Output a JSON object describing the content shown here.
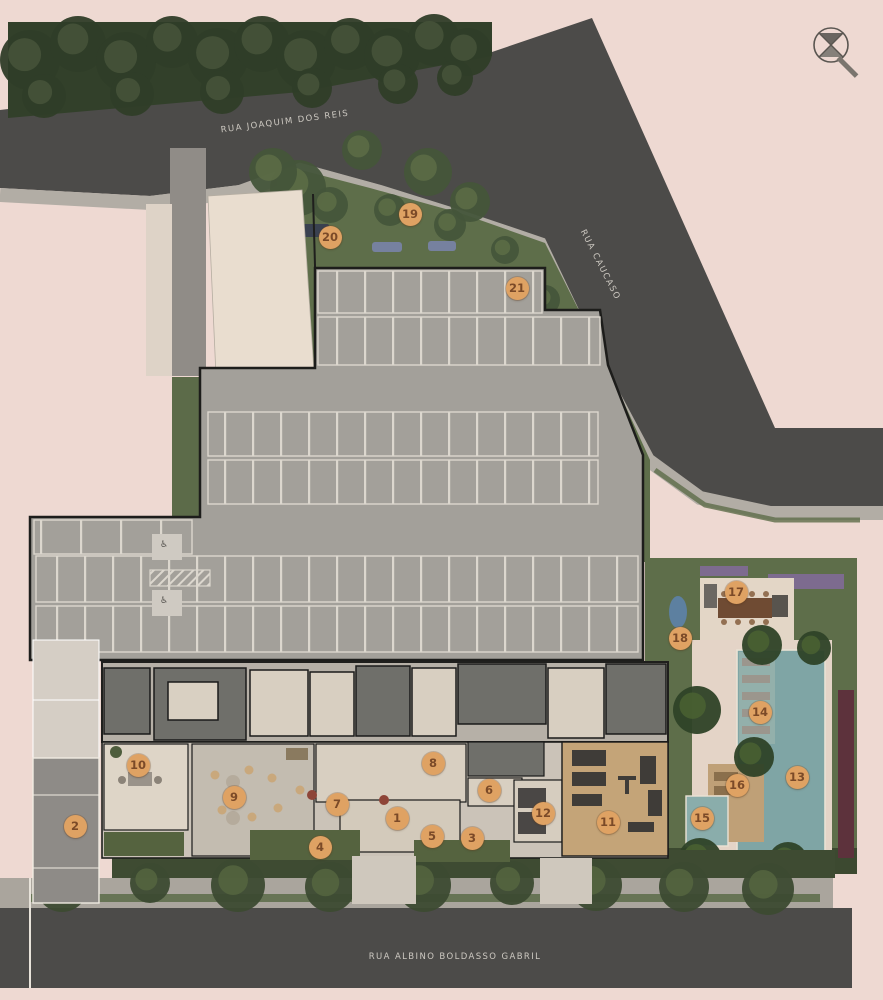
{
  "plan": {
    "title": "residential site / implantation plan",
    "streets": {
      "top": "RUA JOAQUIM DOS REIS",
      "right": "RUA CAUCASO",
      "bottom": "RUA ALBINO BOLDASSO GABRIL"
    },
    "compass": "north-compass",
    "markers": [
      {
        "n": "1",
        "x": 397,
        "y": 818
      },
      {
        "n": "2",
        "x": 75,
        "y": 826
      },
      {
        "n": "3",
        "x": 472,
        "y": 838
      },
      {
        "n": "4",
        "x": 320,
        "y": 847
      },
      {
        "n": "5",
        "x": 432,
        "y": 836
      },
      {
        "n": "6",
        "x": 489,
        "y": 790
      },
      {
        "n": "7",
        "x": 337,
        "y": 804
      },
      {
        "n": "8",
        "x": 433,
        "y": 763
      },
      {
        "n": "9",
        "x": 234,
        "y": 797
      },
      {
        "n": "10",
        "x": 138,
        "y": 765
      },
      {
        "n": "11",
        "x": 608,
        "y": 822
      },
      {
        "n": "12",
        "x": 543,
        "y": 813
      },
      {
        "n": "13",
        "x": 797,
        "y": 777
      },
      {
        "n": "14",
        "x": 760,
        "y": 712
      },
      {
        "n": "15",
        "x": 702,
        "y": 818
      },
      {
        "n": "16",
        "x": 737,
        "y": 785
      },
      {
        "n": "17",
        "x": 736,
        "y": 592
      },
      {
        "n": "18",
        "x": 680,
        "y": 638
      },
      {
        "n": "19",
        "x": 410,
        "y": 214
      },
      {
        "n": "20",
        "x": 330,
        "y": 237
      },
      {
        "n": "21",
        "x": 517,
        "y": 288
      }
    ]
  },
  "colors": {
    "background": "#eed9d2",
    "street": "#4c4b49",
    "sidewalk": "#b2ada5",
    "forest": "#32402a",
    "lawn": "#5e6e4a",
    "parking": "#a3a09a",
    "stall_line": "#dcd7ce",
    "building_dark": "#6f6f6a",
    "building_cream": "#d8cfc1",
    "wood_deck": "#c4a478",
    "pool_water": "#7fa5a5",
    "kids_pool": "#8aadab",
    "purple_bed": "#7d6b8f",
    "maroon_bed": "#5d323c",
    "marker_bg": "#dfa263",
    "marker_text": "#7b4a28",
    "label_text": "#e8e3da"
  },
  "foliage": {
    "forest": {
      "fill": "#2f3d28",
      "core": "#46543a",
      "dots": [
        [
          30,
          60,
          30
        ],
        [
          78,
          44,
          28
        ],
        [
          126,
          62,
          30
        ],
        [
          172,
          42,
          26
        ],
        [
          218,
          58,
          30
        ],
        [
          262,
          44,
          28
        ],
        [
          306,
          60,
          30
        ],
        [
          350,
          44,
          26
        ],
        [
          392,
          56,
          28
        ],
        [
          434,
          40,
          26
        ],
        [
          468,
          52,
          24
        ],
        [
          44,
          96,
          22
        ],
        [
          132,
          94,
          22
        ],
        [
          222,
          92,
          22
        ],
        [
          312,
          88,
          20
        ],
        [
          398,
          84,
          20
        ],
        [
          455,
          78,
          18
        ]
      ]
    },
    "garden": {
      "fill": "#44553a",
      "core": "#5d6d46",
      "dots": [
        [
          298,
          188,
          28
        ],
        [
          273,
          172,
          24
        ],
        [
          362,
          150,
          20
        ],
        [
          428,
          172,
          24
        ],
        [
          470,
          202,
          20
        ],
        [
          330,
          205,
          18
        ],
        [
          390,
          210,
          16
        ],
        [
          450,
          225,
          16
        ],
        [
          505,
          250,
          14
        ],
        [
          545,
          300,
          15
        ],
        [
          572,
          342,
          14
        ]
      ]
    },
    "caucaso": {
      "fill": "#44553a",
      "core": "#5d6d46",
      "dots": [
        [
          497,
          128,
          20
        ],
        [
          528,
          200,
          22
        ],
        [
          560,
          274,
          22
        ],
        [
          594,
          348,
          22
        ],
        [
          632,
          418,
          22
        ],
        [
          694,
          470,
          20
        ],
        [
          790,
          488,
          22
        ],
        [
          850,
          492,
          16
        ]
      ]
    },
    "bottom": {
      "fill": "#3c4a31",
      "core": "#55653f",
      "dots": [
        [
          62,
          886,
          26
        ],
        [
          150,
          883,
          20
        ],
        [
          238,
          885,
          27
        ],
        [
          330,
          887,
          25
        ],
        [
          424,
          885,
          27
        ],
        [
          512,
          883,
          22
        ],
        [
          596,
          885,
          26
        ],
        [
          684,
          887,
          25
        ],
        [
          768,
          889,
          26
        ]
      ]
    },
    "palms": {
      "fill": "#2e4227",
      "core": "#4a6231",
      "dots": [
        [
          697,
          710,
          24
        ],
        [
          762,
          645,
          20
        ],
        [
          814,
          648,
          17
        ],
        [
          754,
          757,
          20
        ],
        [
          700,
          860,
          22
        ],
        [
          788,
          862,
          20
        ]
      ]
    }
  }
}
